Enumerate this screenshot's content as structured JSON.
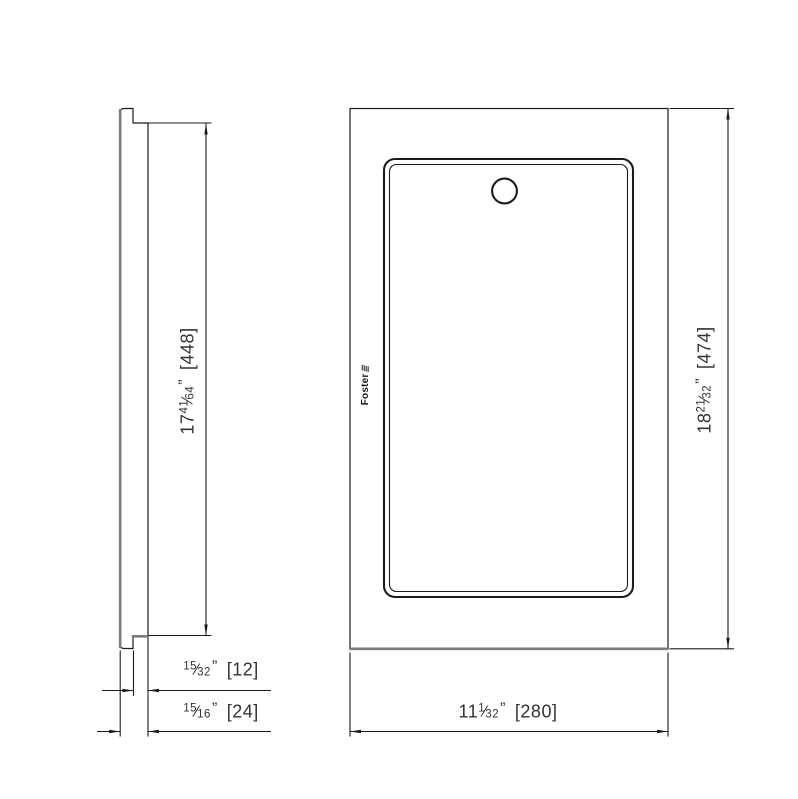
{
  "colors": {
    "background": "#ffffff",
    "line": "#1b1b1b",
    "thick_edge": "#7d7d7d",
    "text": "#333333"
  },
  "logo": {
    "text": "Foster",
    "mark": "≣"
  },
  "dimensions": {
    "side_height": {
      "whole": "17",
      "num": "41",
      "slash": "⁄",
      "den": "64",
      "unit": "”",
      "mm": "[448]"
    },
    "side_lip_thickness": {
      "whole": "",
      "num": "15",
      "slash": "⁄",
      "den": "32",
      "unit": "”",
      "mm": "[12]"
    },
    "side_total_thickness": {
      "whole": "",
      "num": "15",
      "slash": "⁄",
      "den": "16",
      "unit": "”",
      "mm": "[24]"
    },
    "front_width": {
      "whole": "11",
      "num": "1",
      "slash": "⁄",
      "den": "32",
      "unit": "”",
      "mm": "[280]"
    },
    "front_height": {
      "whole": "18",
      "num": "21",
      "slash": "⁄",
      "den": "32",
      "unit": "”",
      "mm": "[474]"
    }
  }
}
